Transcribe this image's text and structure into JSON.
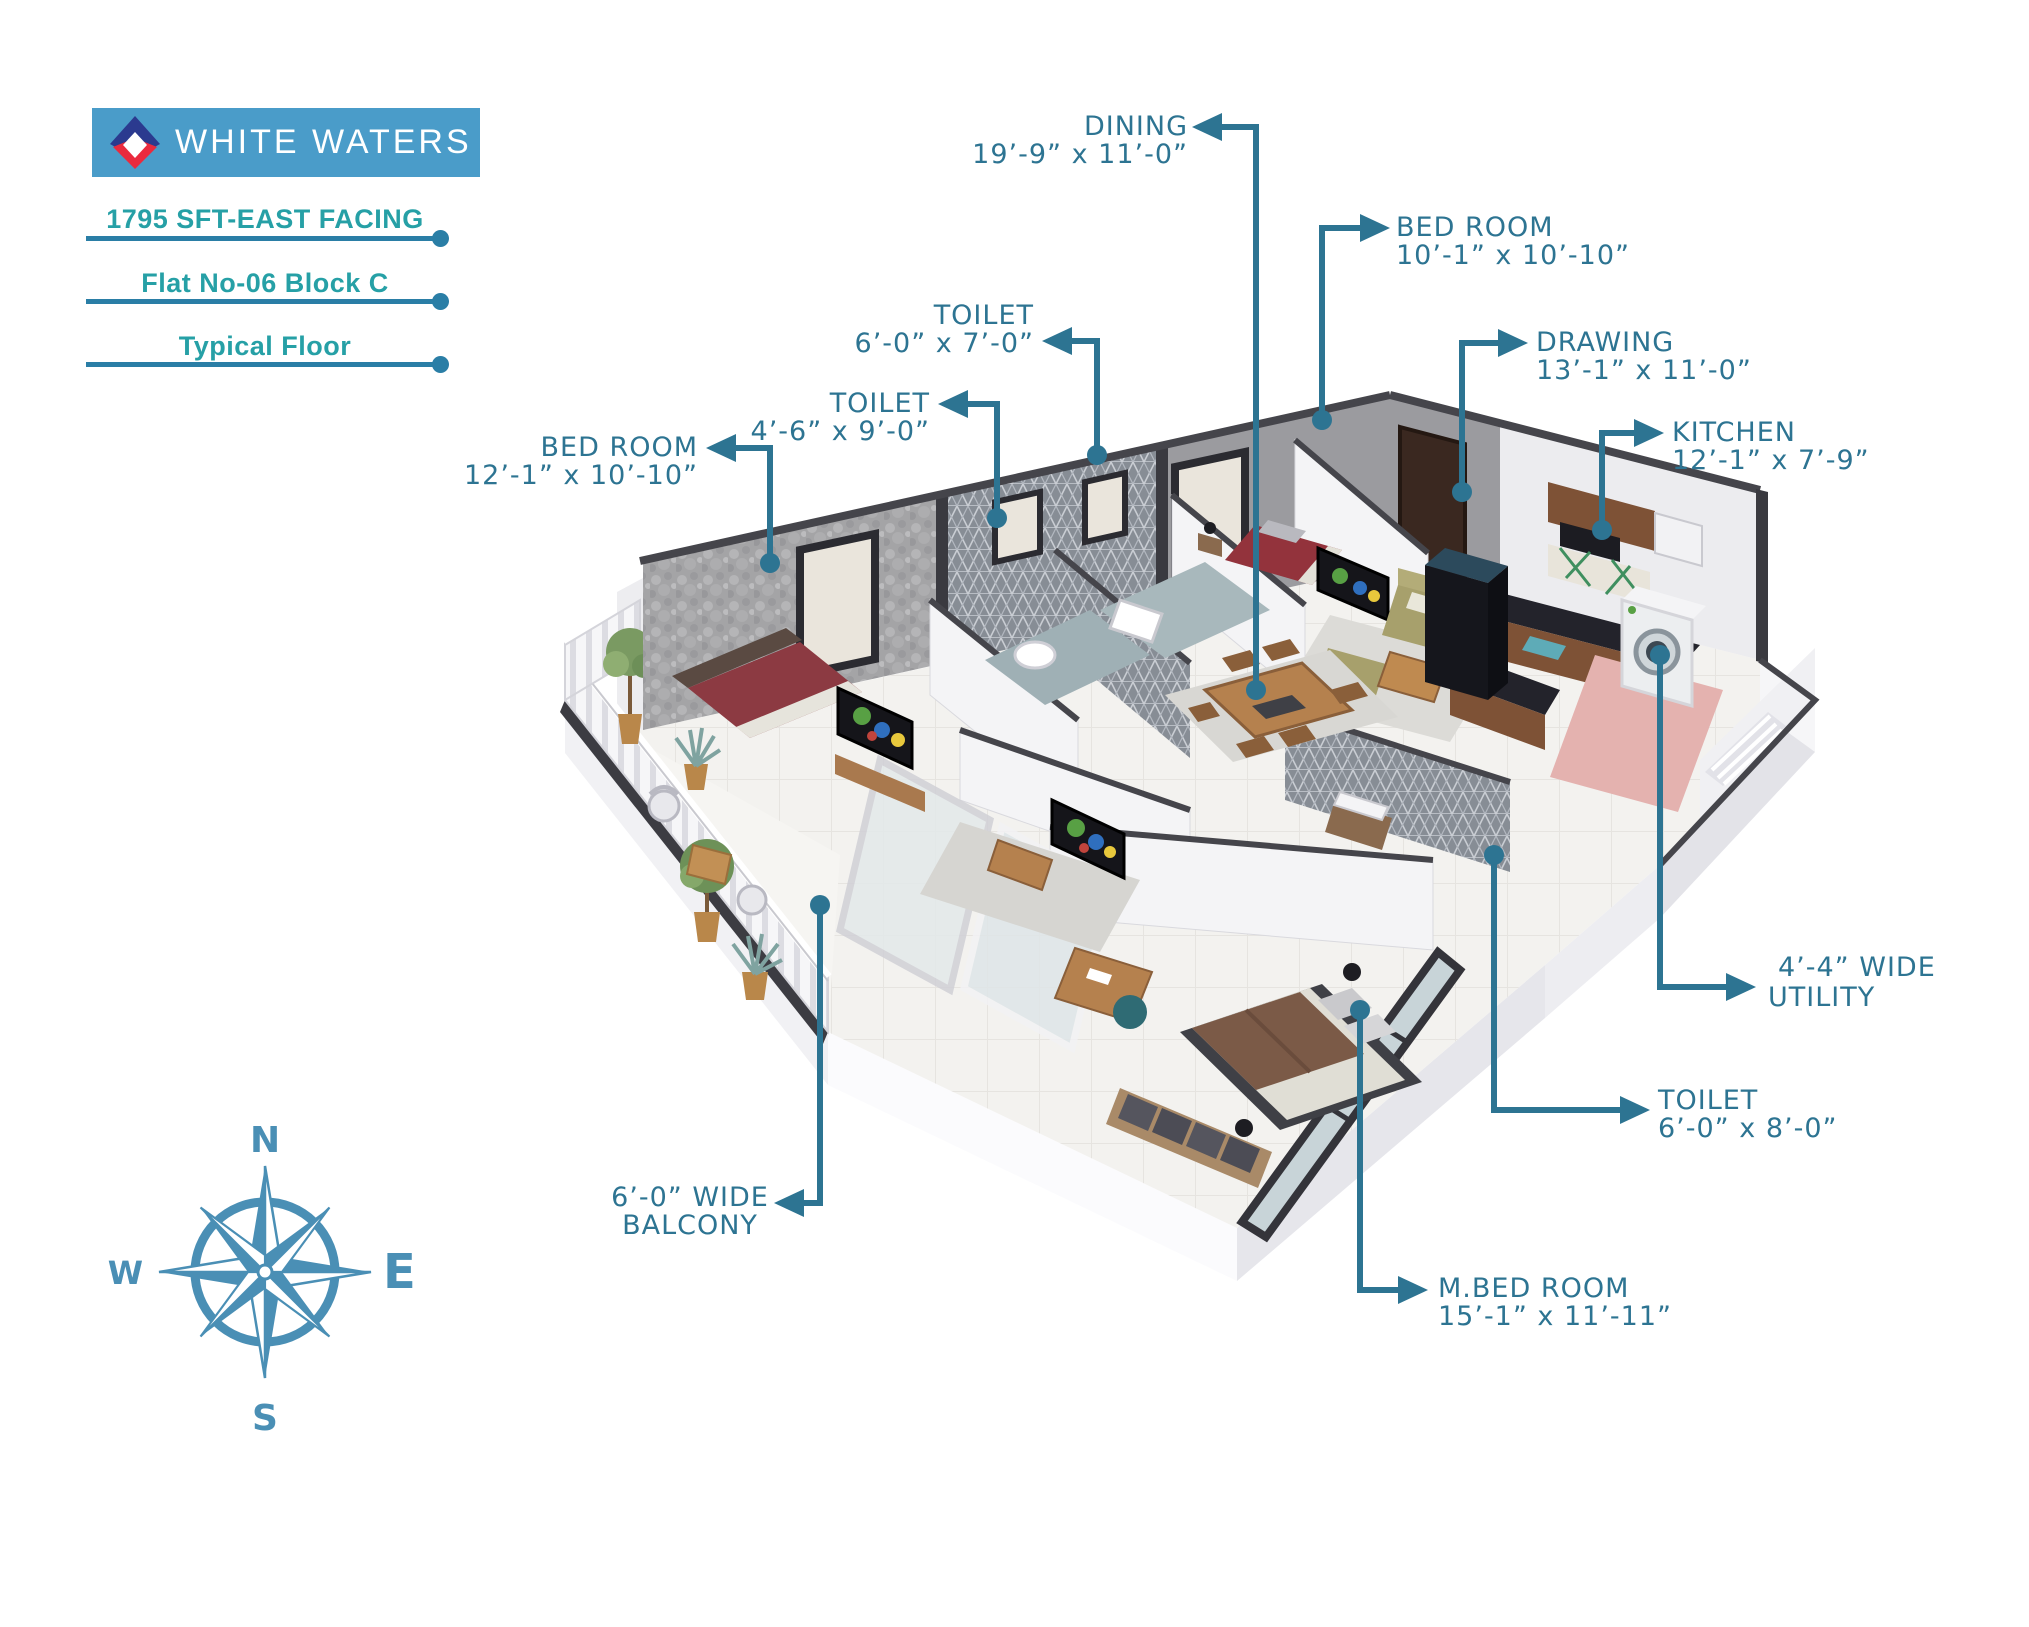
{
  "brand": {
    "name": "WHITE WATERS",
    "banner_color": "#4a9cc9",
    "logo_navy": "#2b3a8f",
    "logo_red": "#ea2a3e"
  },
  "project": {
    "lines": [
      "1795 SFT-EAST FACING",
      "Flat No-06 Block C",
      "Typical Floor"
    ]
  },
  "compass": {
    "north": "N",
    "east": "E",
    "south": "S",
    "west": "W",
    "color": "#4a8fb5"
  },
  "labels": [
    {
      "id": "dining",
      "line1": "DINING",
      "line2": "19’-9” x 11’-0”"
    },
    {
      "id": "bedroom-top",
      "line1": "BED ROOM",
      "line2": "10’-1” x 10’-10”"
    },
    {
      "id": "drawing",
      "line1": "DRAWING",
      "line2": "13’-1” x 11’-0”"
    },
    {
      "id": "kitchen",
      "line1": "KITCHEN",
      "line2": "12’-1” x 7’-9”"
    },
    {
      "id": "toilet-1",
      "line1": "TOILET",
      "line2": "6’-0” x 7’-0”"
    },
    {
      "id": "toilet-2",
      "line1": "TOILET",
      "line2": "4’-6” x 9’-0”"
    },
    {
      "id": "bedroom-left",
      "line1": "BED ROOM",
      "line2": "12’-1” x 10’-10”"
    },
    {
      "id": "balcony",
      "line1": "6’-0” WIDE",
      "line2": "BALCONY"
    },
    {
      "id": "m-bedroom",
      "line1": "M.BED ROOM",
      "line2": "15’-1” x 11’-11”"
    },
    {
      "id": "toilet-3",
      "line1": "TOILET",
      "line2": "6’-0” x 8’-0”"
    },
    {
      "id": "utility",
      "line1": "4’-4” WIDE",
      "line2": "UTILITY"
    }
  ],
  "colors": {
    "label_text": "#2d7492",
    "leader_line": "#2d7492",
    "info_teal": "#26a0a6",
    "rule_blue": "#2a7ea6",
    "compass": "#4a8fb5"
  }
}
